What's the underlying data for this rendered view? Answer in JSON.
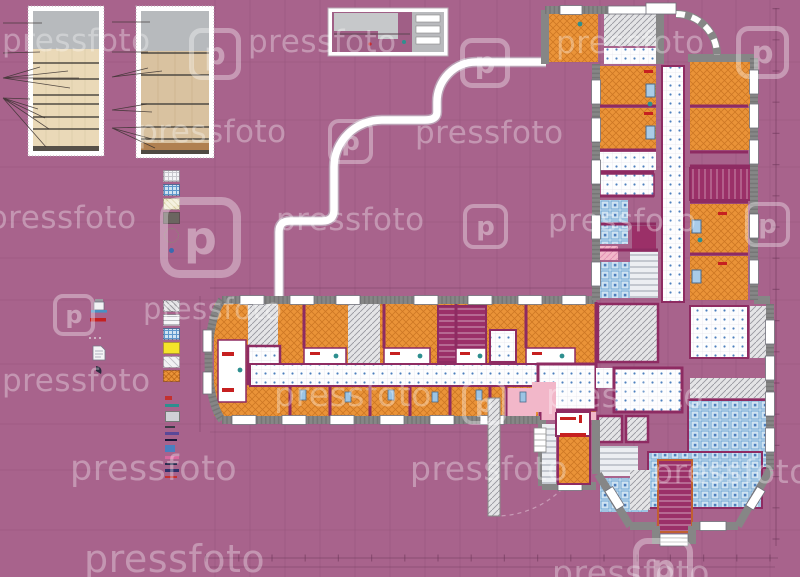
{
  "image": {
    "subject": "apartment building floor plan drawing",
    "stock_site": "pressfoto"
  },
  "watermark": {
    "text": "pressfoto",
    "logo_letter": "p",
    "instances": [
      {
        "t": "text",
        "x": 2,
        "y": 26,
        "s": 31
      },
      {
        "t": "logo",
        "x": 189,
        "y": 28,
        "s": 27
      },
      {
        "t": "text",
        "x": 248,
        "y": 27,
        "s": 31
      },
      {
        "t": "logo",
        "x": 460,
        "y": 38,
        "s": 26
      },
      {
        "t": "text",
        "x": 556,
        "y": 28,
        "s": 31
      },
      {
        "t": "logo",
        "x": 736,
        "y": 26,
        "s": 28
      },
      {
        "t": "text",
        "x": 138,
        "y": 117,
        "s": 31
      },
      {
        "t": "logo",
        "x": 328,
        "y": 119,
        "s": 24
      },
      {
        "t": "text",
        "x": 415,
        "y": 118,
        "s": 31
      },
      {
        "t": "text",
        "x": -12,
        "y": 203,
        "s": 31
      },
      {
        "t": "logo",
        "x": 160,
        "y": 197,
        "s": 42
      },
      {
        "t": "text",
        "x": 276,
        "y": 205,
        "s": 31
      },
      {
        "t": "logo",
        "x": 463,
        "y": 204,
        "s": 24
      },
      {
        "t": "text",
        "x": 548,
        "y": 206,
        "s": 31
      },
      {
        "t": "logo",
        "x": 745,
        "y": 202,
        "s": 24
      },
      {
        "t": "logo",
        "x": 53,
        "y": 294,
        "s": 22
      },
      {
        "t": "text",
        "x": 143,
        "y": 295,
        "s": 29
      },
      {
        "t": "text",
        "x": 2,
        "y": 366,
        "s": 31
      },
      {
        "t": "text",
        "x": 274,
        "y": 378,
        "s": 33
      },
      {
        "t": "logo",
        "x": 462,
        "y": 381,
        "s": 23
      },
      {
        "t": "text",
        "x": 546,
        "y": 379,
        "s": 33
      },
      {
        "t": "text",
        "x": 70,
        "y": 452,
        "s": 35
      },
      {
        "t": "text",
        "x": 410,
        "y": 452,
        "s": 33
      },
      {
        "t": "text",
        "x": 652,
        "y": 455,
        "s": 33
      },
      {
        "t": "text",
        "x": 84,
        "y": 540,
        "s": 38
      },
      {
        "t": "text",
        "x": 552,
        "y": 556,
        "s": 33
      },
      {
        "t": "logo",
        "x": 633,
        "y": 538,
        "s": 31
      }
    ]
  },
  "colors": {
    "bg": "#a8638c",
    "wall_purple": "#8e2b62",
    "wall_gray": "#868686",
    "orange": "#ea9338",
    "orange_line": "#b95f10",
    "blue_tile_bg": "#cfe3f2",
    "blue_tile": "#6fa5d2",
    "dot_blue": "#4d7fbe",
    "hatch_bg": "#e4e4e6",
    "hatch_line": "#97979f",
    "stair_purple": "#9b3068",
    "tread_bg": "#eceef2",
    "pink": "#f2b7c9",
    "yellow": "#f4e32a",
    "outline_white": "#ffffff",
    "dim_line": "#6b3558",
    "beige": "#ead9b8",
    "tan": "#d9c2a0",
    "gray_band": "#b7babd",
    "red_fixture": "#c62020",
    "teal_fixture": "#2e8f8f"
  },
  "legend": {
    "swatches_top": [
      {
        "type": "white-grid"
      },
      {
        "type": "blue-tile"
      },
      {
        "type": "cream-hatch"
      },
      {
        "type": "dark-solid"
      },
      {
        "type": "dot-circle"
      },
      {
        "type": "tiny-dot"
      }
    ],
    "swatches_main": [
      {
        "type": "gray-hatch"
      },
      {
        "type": "white-lined"
      },
      {
        "type": "blue-tile"
      },
      {
        "type": "yellow-solid"
      },
      {
        "type": "white-diag"
      },
      {
        "type": "orange-hatch"
      }
    ],
    "marks": [
      {
        "color": "#c43030",
        "w": 7,
        "h": 4
      },
      {
        "color": "#2e8f8f",
        "w": 14,
        "h": 3
      },
      {
        "color": "#cfd0d6",
        "w": 13,
        "h": 9,
        "box": true
      },
      {
        "color": "#3a3a46",
        "w": 10,
        "h": 2
      },
      {
        "color": "#5a4898",
        "w": 14,
        "h": 3
      },
      {
        "color": "#16163a",
        "w": 12,
        "h": 2
      },
      {
        "color": "#4a7fc0",
        "w": 10,
        "h": 7
      },
      {
        "color": "#d8679e",
        "w": 14,
        "h": 3
      },
      {
        "color": "#2a2a4e",
        "w": 12,
        "h": 2
      },
      {
        "color": "#30306a",
        "w": 14,
        "h": 3
      },
      {
        "color": "#c43030",
        "w": 12,
        "h": 2
      }
    ]
  }
}
